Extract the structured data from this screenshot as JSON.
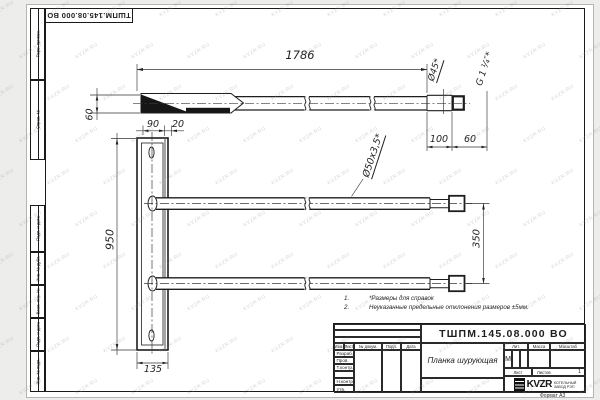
{
  "doc": {
    "designation": "ТШПМ.145.08.000 ВО",
    "name": "Планка шурующая",
    "format_label": "Формат А3"
  },
  "stamps": {
    "side": [
      "Перв. примен.",
      "Справ. №",
      "Подп. и дата",
      "Инв. № дубл.",
      "Взам. инв. №",
      "Подп. и дата",
      "Инв. № подл."
    ]
  },
  "dims": {
    "overall_length": "1786",
    "left_height": "60",
    "web": "90",
    "flange": "20",
    "plank_height": "950",
    "base_width": "135",
    "tube_pitch": "350",
    "neck_length": "100",
    "end_length": "60",
    "end_dia": "Ø45*",
    "tube_dia": "Ø50х3,5*",
    "thread": "G 1 ¼″*"
  },
  "notes": [
    {
      "num": "1.",
      "text": "*Размеры для справок"
    },
    {
      "num": "2.",
      "text": "Неуказанные предельные отклонения размеров ±5мм."
    }
  ],
  "title_block": {
    "headers": {
      "change": "Изм.",
      "sheet": "Лист",
      "doc_no": "№ докум.",
      "sign": "Подп.",
      "date": "Дата",
      "litera": "Лит.",
      "mass": "Масса",
      "scale": "Масштаб"
    },
    "sig_rows": [
      "Разраб.",
      "Пров.",
      "Т.контр.",
      "Н.контр.",
      "Утв."
    ],
    "litera_value": "М",
    "sheet_label": "Лист",
    "sheets_label": "Листов",
    "sheets_value": "1"
  },
  "logo": {
    "brand": "KVZR",
    "org_line1": "КОТЕЛЬНЫЙ",
    "org_line2": "ЗАВОД РЭП"
  },
  "watermark": {
    "text": "KVZR.RU"
  }
}
